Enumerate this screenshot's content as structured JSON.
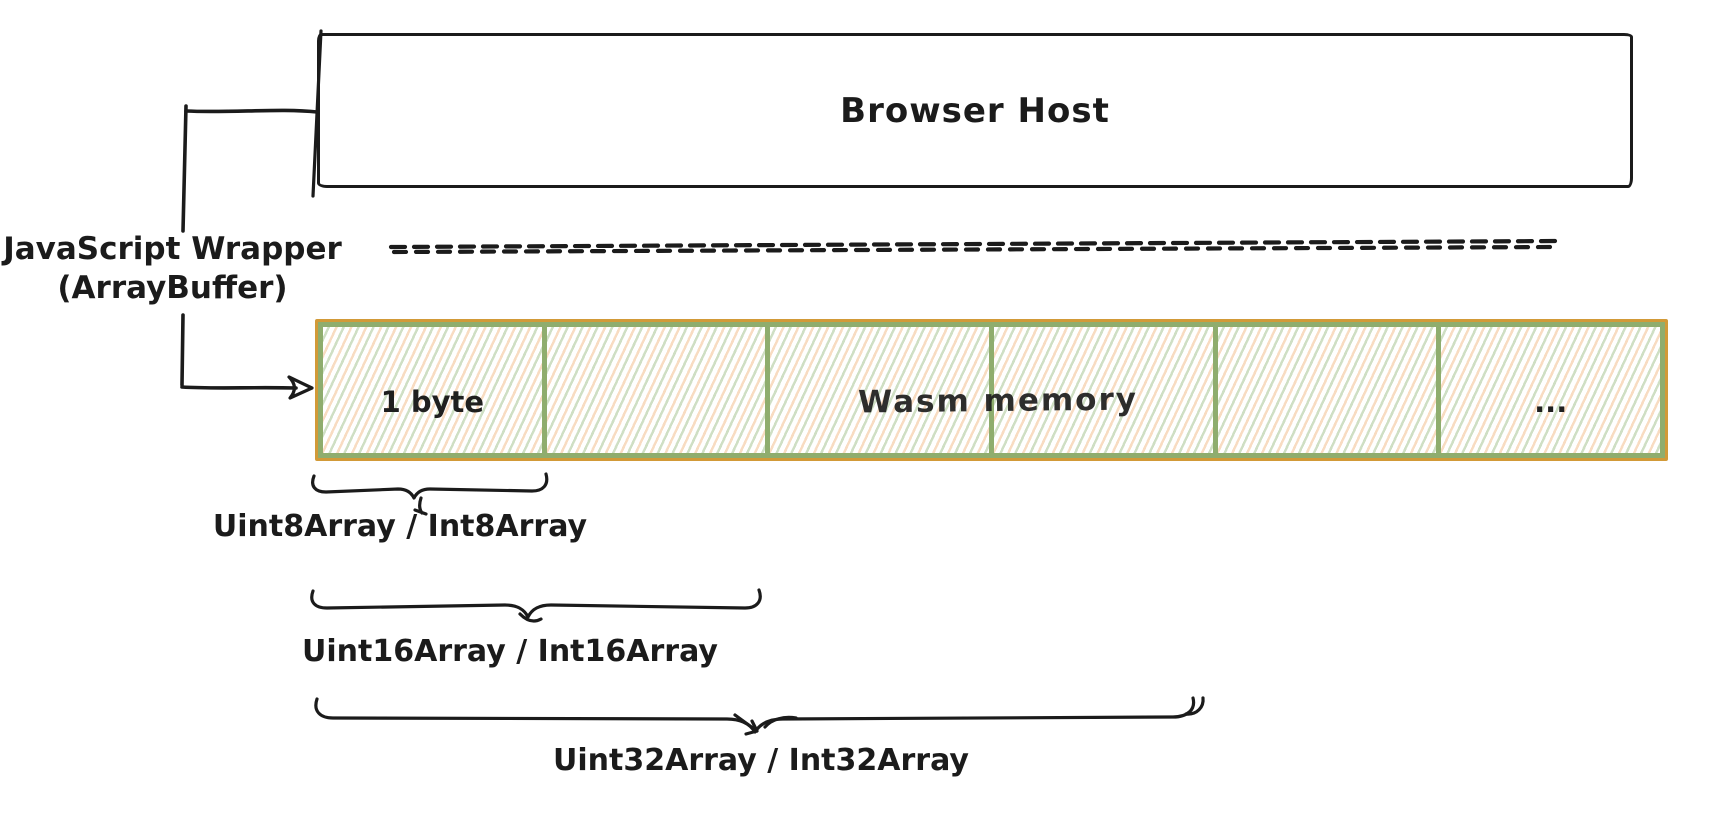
{
  "diagram": {
    "host_label": "Browser Host",
    "wrapper_label_line1": "JavaScript Wrapper",
    "wrapper_label_line2": "(ArrayBuffer)",
    "memory": {
      "cell1_label": "1 byte",
      "memory_label": "Wasm memory",
      "ellipsis": "..."
    },
    "braces": [
      {
        "label": "Uint8Array / Int8Array"
      },
      {
        "label": "Uint16Array / Int16Array"
      },
      {
        "label": "Uint32Array / Int32Array"
      }
    ],
    "colors": {
      "stroke": "#1b1b1b",
      "cell_border_green": "#8fad6e",
      "outer_border_orange": "#d29a38",
      "hatch_green": "#cfdfc4",
      "hatch_orange": "#f8dcc2"
    }
  }
}
